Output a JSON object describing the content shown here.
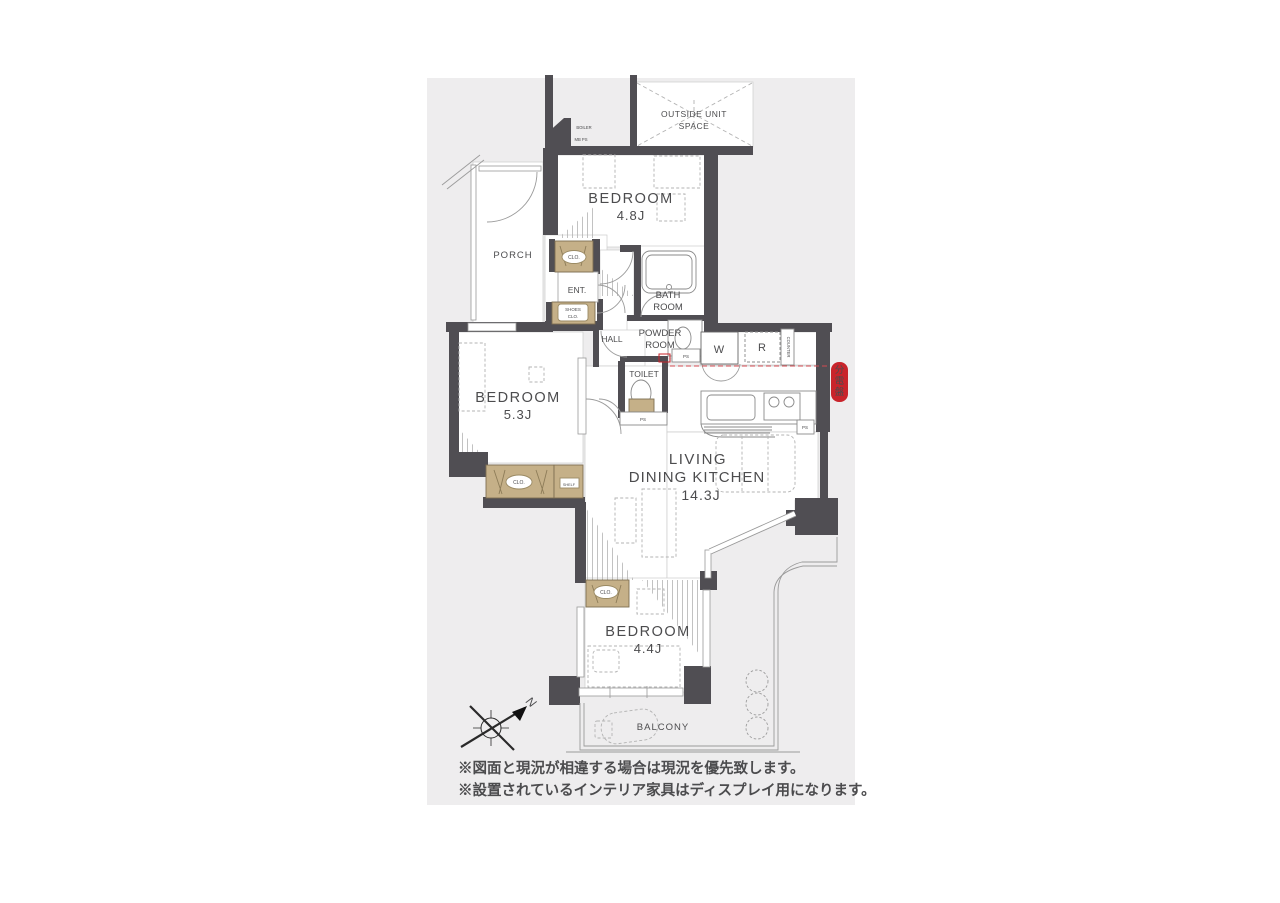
{
  "colors": {
    "panel_bg": "#eeedee",
    "wall": "#504e53",
    "thin_line": "#9b9b9b",
    "closet_fill": "#c5b088",
    "accent_red": "#c9242b",
    "label_text": "#4c4c4e"
  },
  "plan": {
    "outside_unit_1": "OUTSIDE UNIT",
    "outside_unit_2": "SPACE",
    "boiler": "BOILER",
    "mb_ps": "MB PS",
    "bedroom48_name": "BEDROOM",
    "bedroom48_area": "4.8J",
    "porch": "PORCH",
    "clo": "CLO.",
    "ent": "ENT.",
    "shoes_1": "SHOES",
    "shoes_2": "CLO.",
    "bath_1": "BATH",
    "bath_2": "ROOM",
    "powder_1": "POWDER",
    "powder_2": "ROOM",
    "hall": "HALL",
    "toilet": "TOILET",
    "washer": "W",
    "fridge": "R",
    "counter": "COUNTER",
    "ps": "PS",
    "bedroom53_name": "BEDROOM",
    "bedroom53_area": "5.3J",
    "shelf": "SHELF",
    "ldk_1": "LIVING",
    "ldk_2": "DINING KITCHEN",
    "ldk_area": "14.3J",
    "bedroom44_name": "BEDROOM",
    "bedroom44_area": "4.4J",
    "balcony": "BALCONY",
    "dist_board": [
      "分",
      "電",
      "盤"
    ],
    "north": "N"
  },
  "notes": [
    "※図面と現況が相違する場合は現況を優先致します。",
    "※設置されているインテリア家具はディスプレイ用になります。"
  ]
}
